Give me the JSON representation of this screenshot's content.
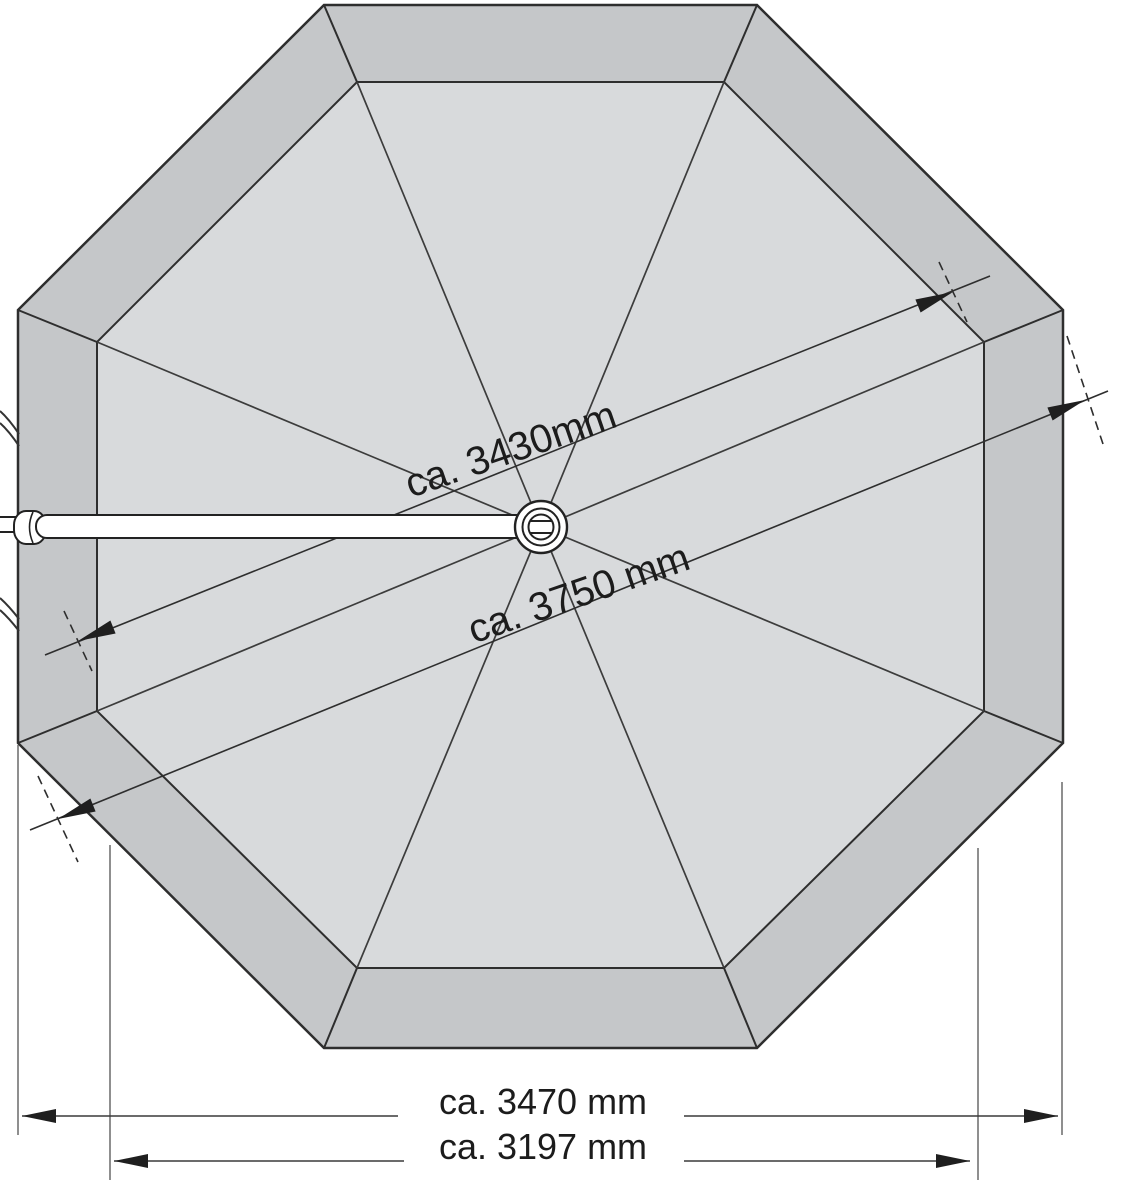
{
  "figure": {
    "dimensions": {
      "inner_span_label": "ca. 3430mm",
      "outer_diagonal_label": "ca. 3750 mm",
      "outer_width_label": "ca. 3470 mm",
      "inner_width_label": "ca. 3197 mm"
    },
    "colors": {
      "rim_fill": "#c5c7c9",
      "canopy_fill": "#d8dadc",
      "outline": "#2e2e2e",
      "pole_fill": "#ffffff",
      "background": "#ffffff"
    }
  }
}
